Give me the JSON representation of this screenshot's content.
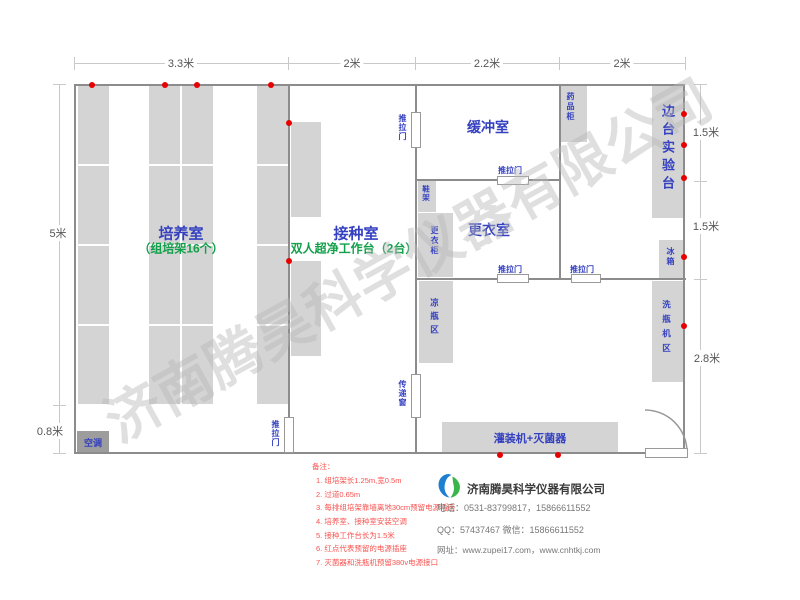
{
  "watermark": "济南腾昊科学仪器有限公司",
  "dimensions": {
    "top": [
      "3.3米",
      "2米",
      "2.2米",
      "2米"
    ],
    "left": [
      "5米",
      "0.8米"
    ],
    "right": [
      "1.5米",
      "1.5米",
      "2.8米"
    ]
  },
  "rooms": {
    "cultivation": {
      "name": "培养室",
      "sub": "（组培架16个）"
    },
    "inoculation": {
      "name": "接种室",
      "sub": "双人超净工作台（2台）"
    },
    "buffer": {
      "name": "缓冲室"
    },
    "changing": {
      "name": "更衣室"
    }
  },
  "fixtures": {
    "side_bench": "边台实验台",
    "medicine_cabinet": "药品柜",
    "fridge": "冰箱",
    "washer_area": "洗瓶机区",
    "cooling_area": "凉瓶区",
    "transfer_window": "传递窗",
    "filling_machine": "灌装机+灭菌器",
    "shoe_rack": "鞋架",
    "wardrobe": "更衣柜",
    "ac": "空调",
    "sliding_door": "推拉门"
  },
  "notes": {
    "title": "备注：",
    "items": [
      "1. 组培架长1.25m,宽0.5m",
      "2. 过道0.65m",
      "3. 每排组培架靠墙离地30cm预留电源插座",
      "4. 培养室、接种室安装空调",
      "5. 接种工作台长为1.5米",
      "6. 红点代表预留的电源插座",
      "7. 灭菌器和洗瓶机预留380v电源接口"
    ]
  },
  "company": {
    "name": "济南腾昊科学仪器有限公司",
    "phone": "电话：0531-83799817，15866611552",
    "qq_wechat": "QQ：57437467   微信：15866611552",
    "website": "网址：www.zupei17.com，www.cnhtkj.com"
  },
  "colors": {
    "room_label_blue": "#3440c0",
    "sub_label_green": "#12a04a",
    "note_red": "#f8524f",
    "socket_dot_red": "#e60000",
    "wall_gray": "#8c8c8c",
    "furniture_gray": "#d4d4d4"
  }
}
